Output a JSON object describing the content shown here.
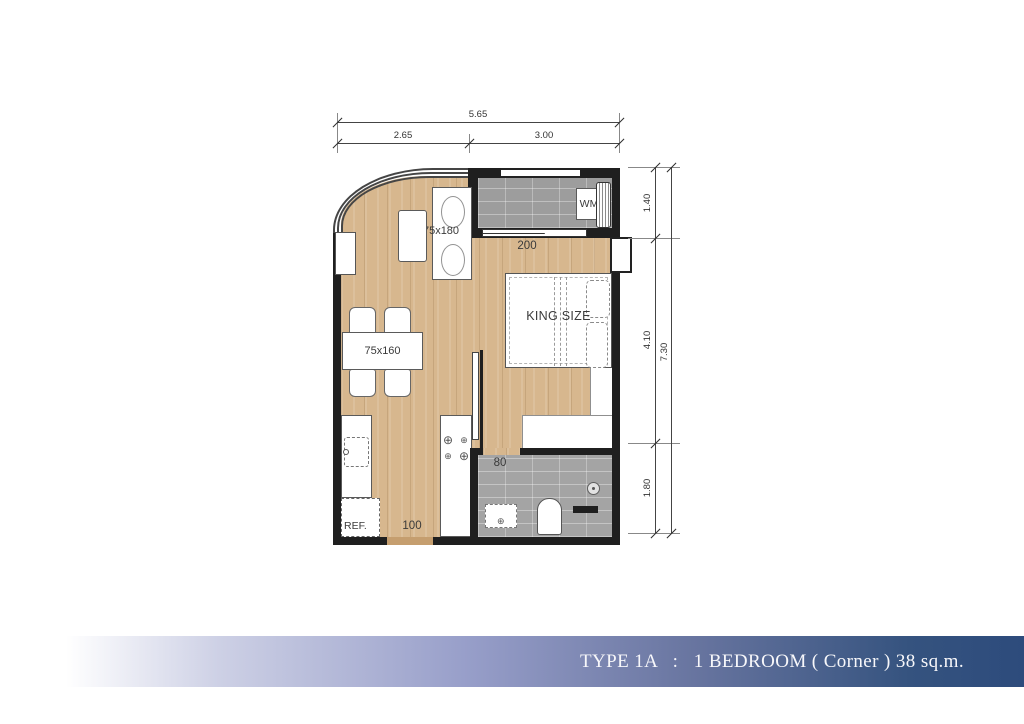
{
  "banner": {
    "text": "TYPE 1A   :   1 BEDROOM ( Corner ) 38 sq.m."
  },
  "dims": {
    "top_total": "5.65",
    "top_seg1": "2.65",
    "top_seg2": "3.00",
    "right_seg1": "1.40",
    "right_seg2": "4.10",
    "right_seg3": "1.80",
    "right_total": "7.30"
  },
  "labels": {
    "sofa": "75x180",
    "dining_table": "75x160",
    "bed": "KING SIZE",
    "balcony_door": "200",
    "washing_machine": "WM",
    "fridge": "REF.",
    "entry_width": "100",
    "bath_door": "80"
  },
  "colors": {
    "wall": "#1f1f1f",
    "wood_floor": "#d7b78e",
    "tile_floor": "#9d9d9d",
    "banner_navy": "#2d4b7c",
    "banner_periwinkle": "#9199c5"
  }
}
